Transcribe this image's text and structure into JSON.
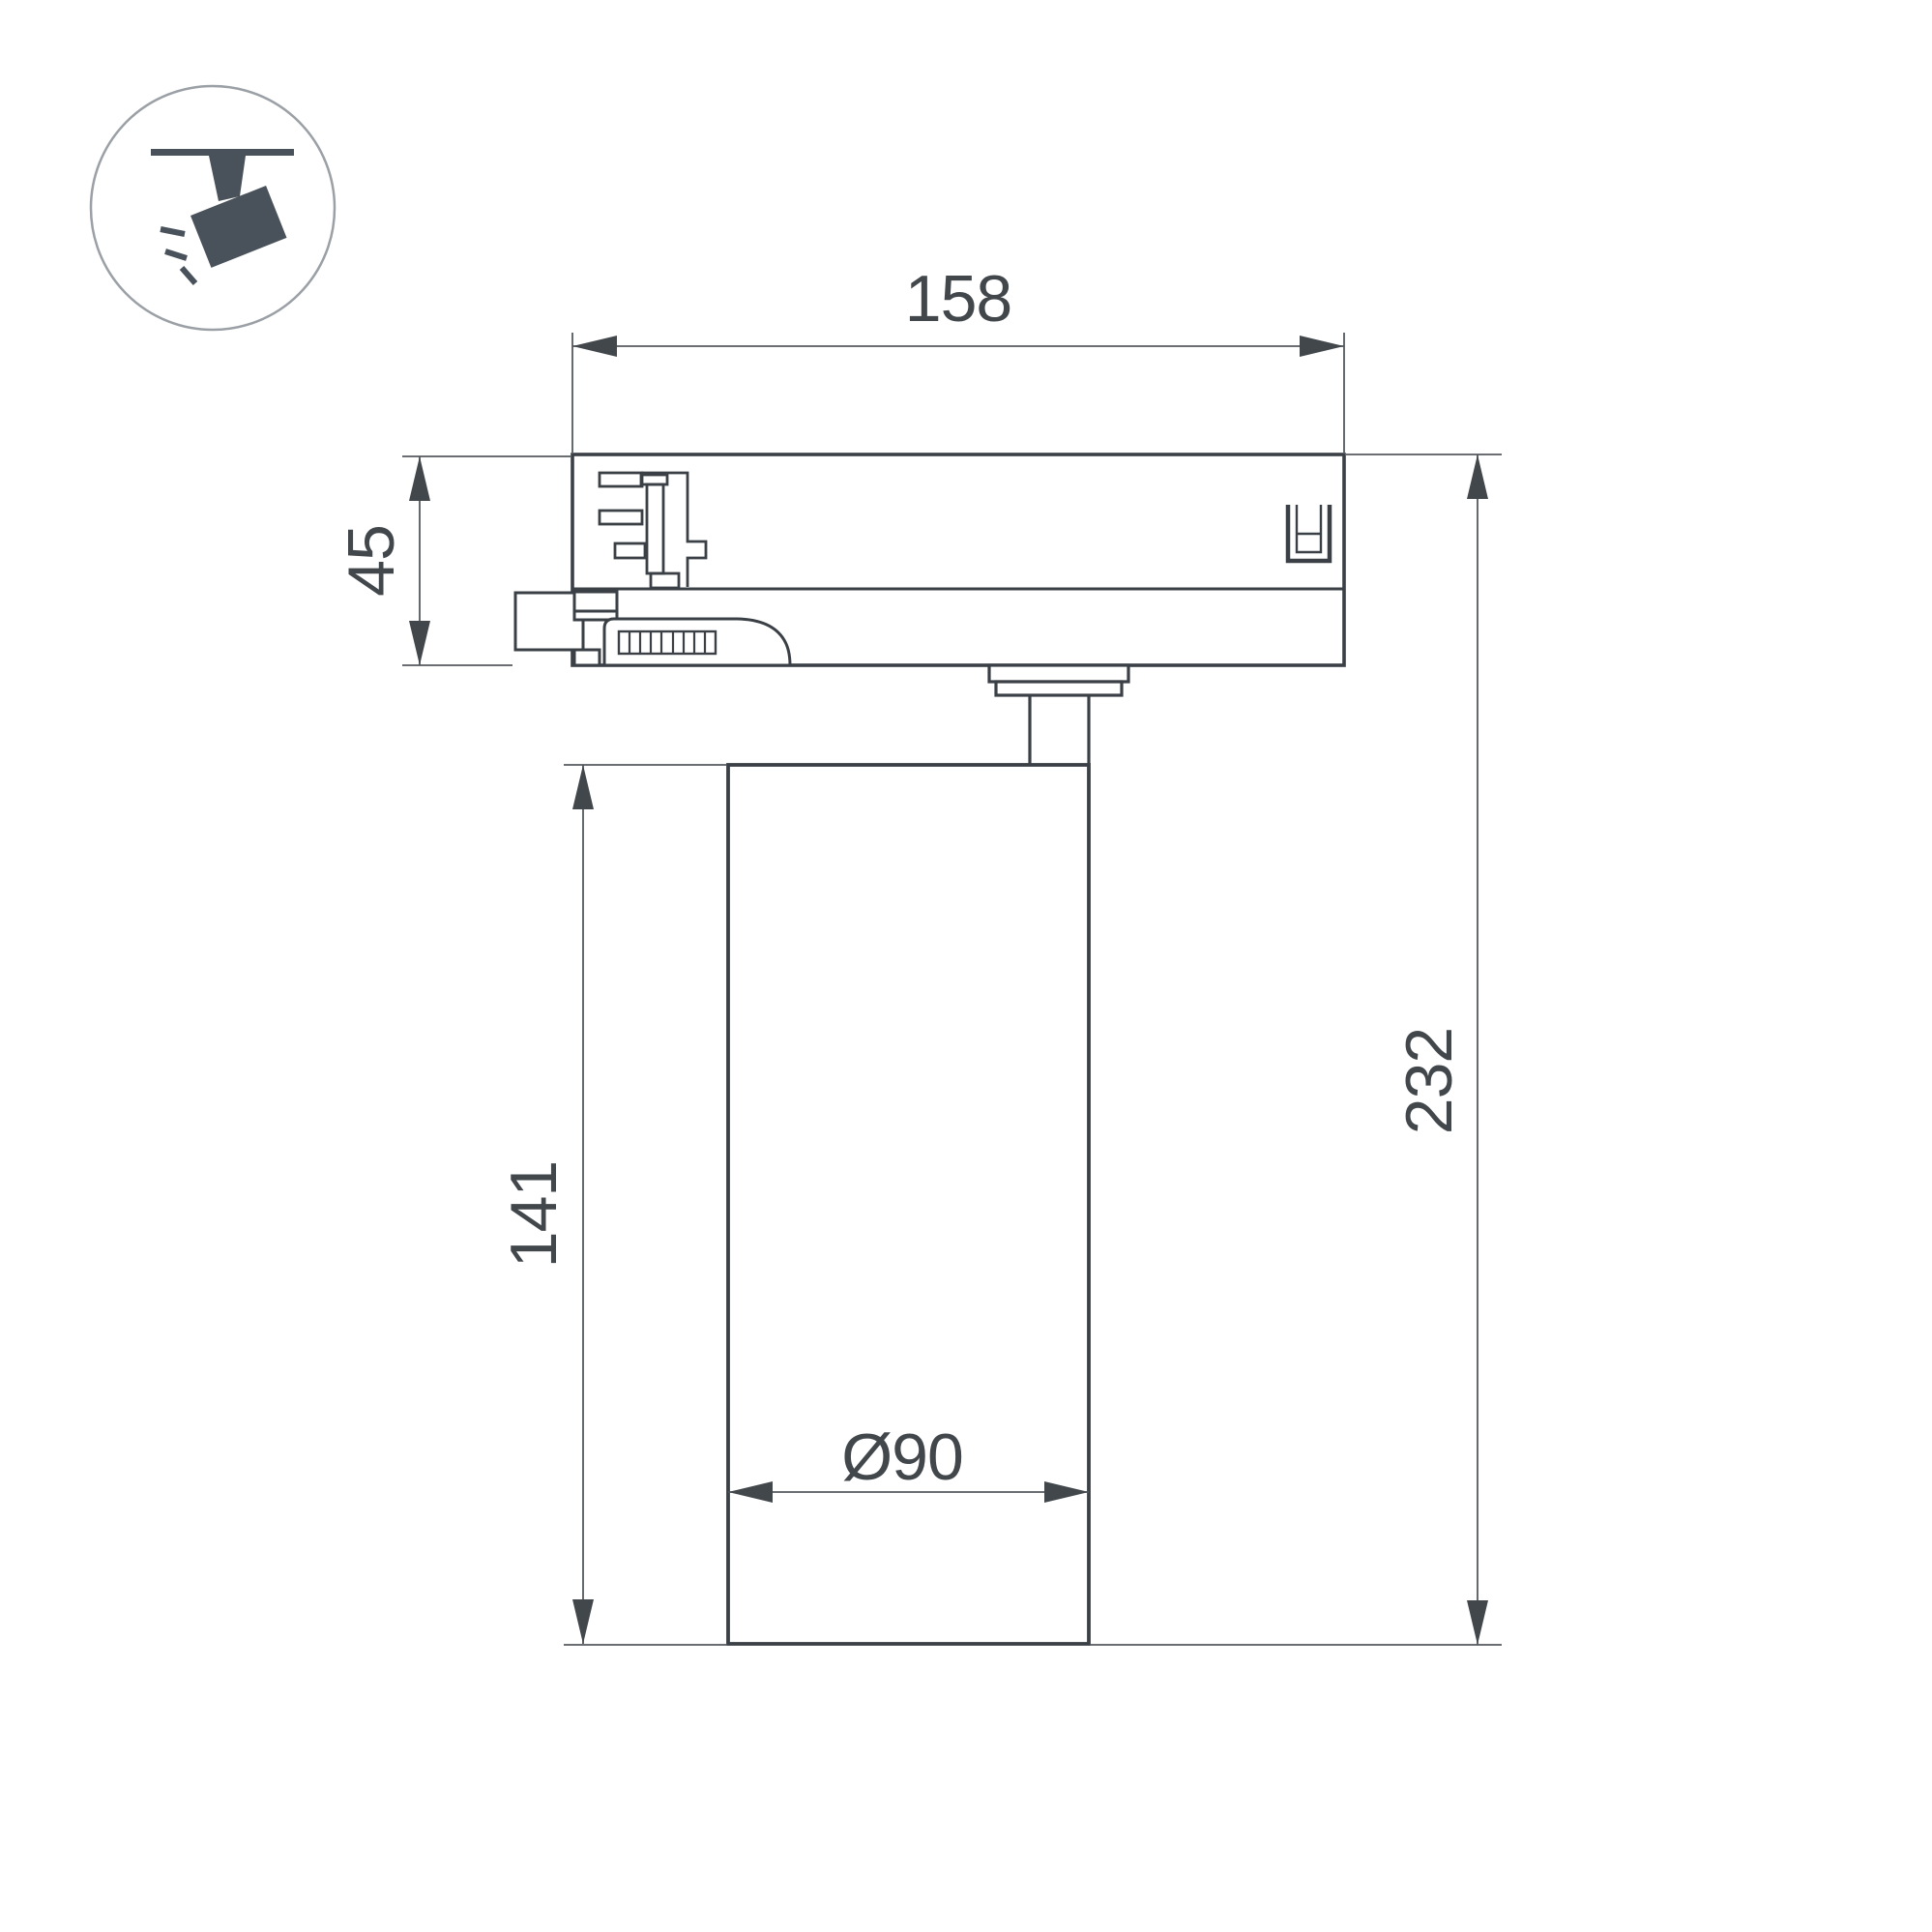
{
  "page": {
    "background": "#ffffff",
    "title": "Track spotlight dimensional drawing"
  },
  "icon": {
    "semantic": "ceiling-track-spotlight",
    "glyph_color": "#49525a",
    "ring_color": "#9aa0a5"
  },
  "drawing": {
    "line_color": "#3a4045",
    "dim_line_color": "#54595e",
    "dim_text_color": "#42474c",
    "labels": {
      "width_top": "158",
      "adapter_height": "45",
      "body_height": "141",
      "total_height": "232",
      "diameter": "Ø90"
    }
  }
}
